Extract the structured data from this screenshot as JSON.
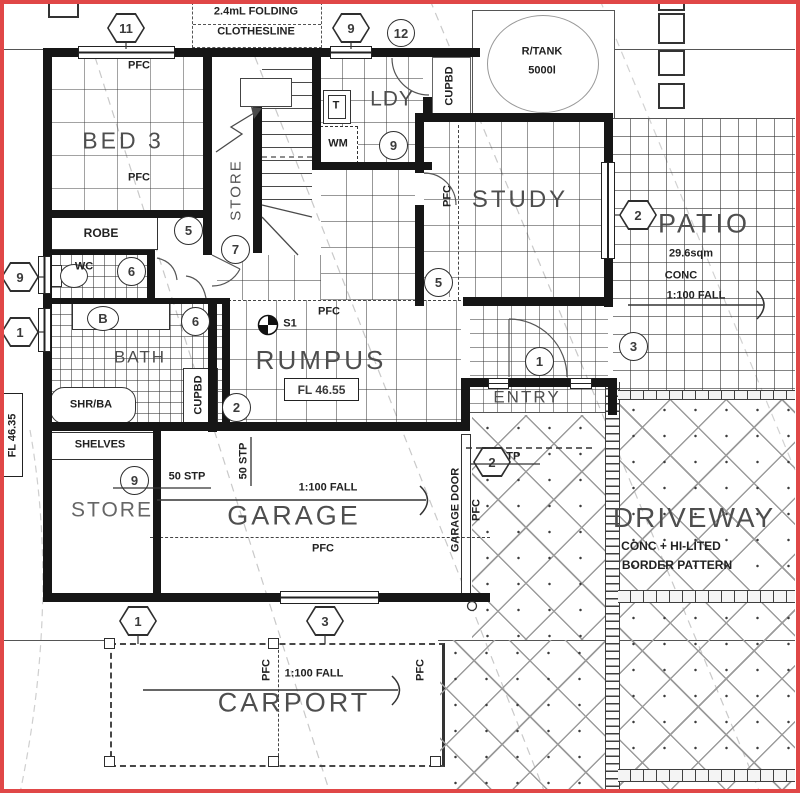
{
  "labels": {
    "clothesline_line1": "2.4mL FOLDING",
    "clothesline_line2": "CLOTHESLINE",
    "pfc": "PFC",
    "bed3": "BED 3",
    "robe": "ROBE",
    "wc": "WC",
    "bath": "BATH",
    "shr_ba": "SHR/BA",
    "shelves": "SHELVES",
    "store": "STORE",
    "ldy": "LDY",
    "tub": "T",
    "wm": "WM",
    "cupbd": "CUPBD",
    "study": "STUDY",
    "rtank_line1": "R/TANK",
    "rtank_line2": "5000l",
    "patio": "PATIO",
    "patio_area": "29.6sqm",
    "patio_conc": "CONC",
    "fall_1_100": "1:100 FALL",
    "rumpus": "RUMPUS",
    "fl_4655": "FL 46.55",
    "fl_4635": "FL 46.35",
    "entry": "ENTRY",
    "stp_25": "25 STP",
    "stp_50": "50 STP",
    "garage": "GARAGE",
    "garage_door": "GARAGE DOOR",
    "driveway": "DRIVEWAY",
    "driveway_line2": "CONC + HI-LITED",
    "driveway_line3": "BORDER PATTERN",
    "carport": "CARPORT",
    "s1": "S1"
  },
  "markers": {
    "n1": "1",
    "n2": "2",
    "n3": "3",
    "n5": "5",
    "n6": "6",
    "n7": "7",
    "n9": "9",
    "n11": "11",
    "n12": "12",
    "nB": "B"
  },
  "colors": {
    "frame_red": "#e04747",
    "wall_black": "#161616",
    "grid_gray": "#8a8a8a",
    "text_dark": "#3a3a3a"
  }
}
